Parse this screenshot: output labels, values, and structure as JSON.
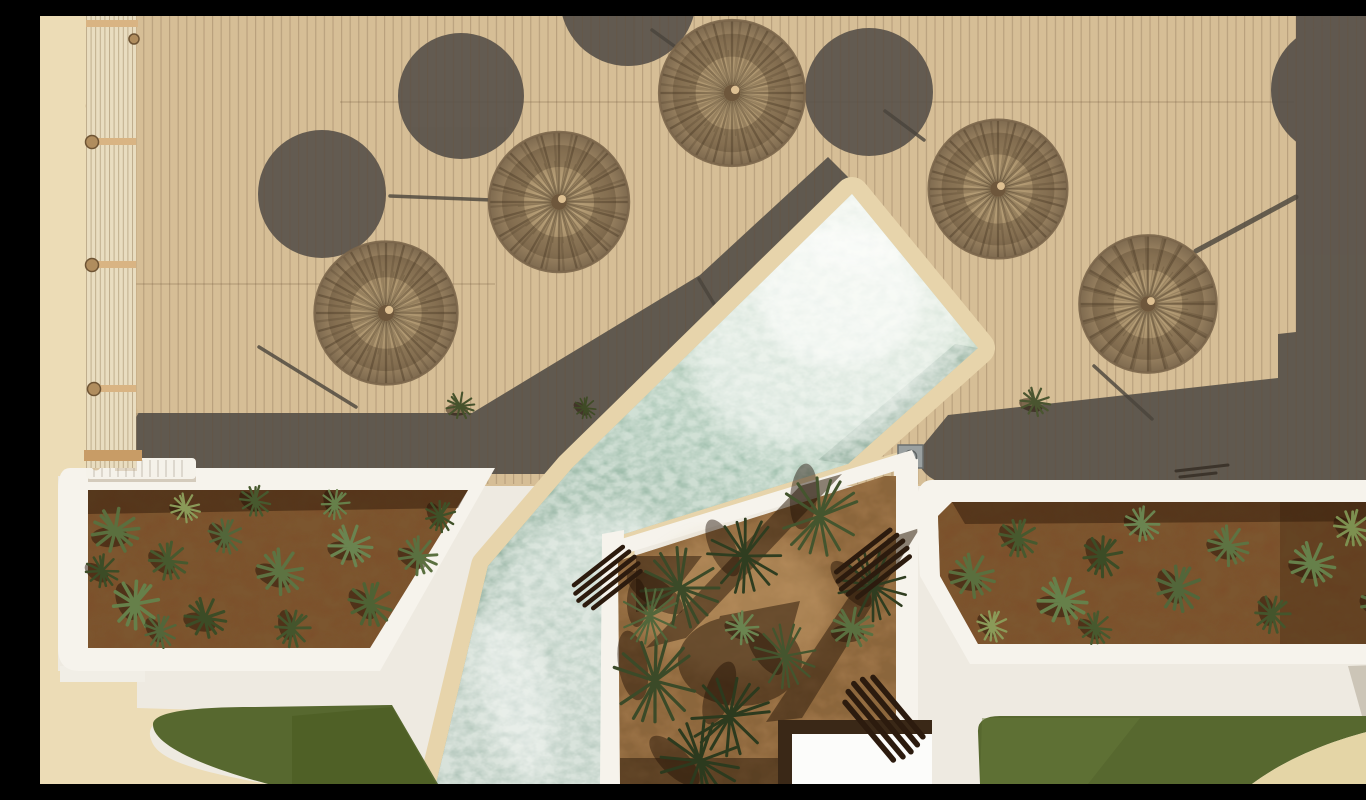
{
  "scene": {
    "description": "Aerial top-down drone photograph of a resort pool deck: five round straw parasols casting circular shadows on tan wooden decking, a diagonal sage-green swimming pool with white stone coping, three white-rimmed planters filled with succulents and small palms, white paving, two patches of green lawn and beige concrete walkways",
    "view": "top-down aerial photograph"
  },
  "palette": {
    "deck_wood": "#d6be96",
    "deck_plank_line": "rgba(105,80,55,0.28)",
    "deck_shadow": "#565049",
    "umbrella_straw_mid": "#b29a73",
    "coping_stone": "#e7d4ab",
    "water_mid": "#a3c2b0",
    "water_deep": "#7d9f8c",
    "foam_white": "#f4f8f2",
    "planter_rim_white": "#f6f3ec",
    "soil_dark_brown": "#7c4e2a",
    "soil_sand": "#a3794c",
    "agave_green": "#5a7040",
    "palm_green": "#33401f",
    "lawn_green": "#57682f",
    "paving_white": "#eeeae1",
    "concrete_beige": "#ecdcb6",
    "beige_path": "#e4d5a6",
    "lounger_wood_dark": "#2c1b0e",
    "accent_red": "#c03c20"
  },
  "objects": {
    "straw_umbrellas": 5,
    "umbrella_shadow_circles": 5,
    "swimming_pools": 1,
    "succulent_planters": 2,
    "palm_planter": 1,
    "lawns": 2,
    "wooden_loungers": 3,
    "white_loungers": 1,
    "pergola": 1
  }
}
